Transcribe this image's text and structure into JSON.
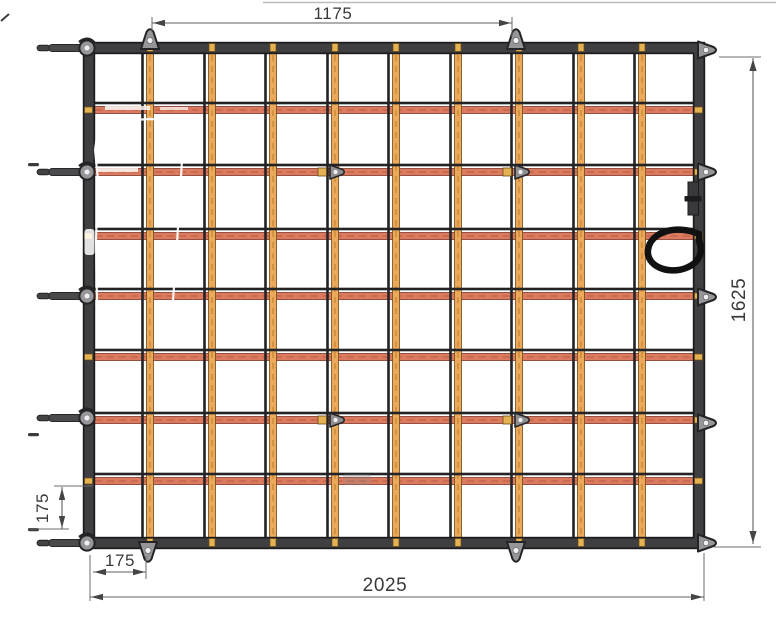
{
  "drawing": {
    "title": "cargo net technical drawing",
    "type": "flat cargo / load-securing net, plan view with dimensions"
  },
  "dimensions": {
    "top_width": {
      "label": "1175"
    },
    "right_height": {
      "label": "1625"
    },
    "bottom_width": {
      "label": "2025"
    },
    "edge_margin_vertical": {
      "label": "175"
    },
    "edge_margin_horizontal": {
      "label": "175"
    }
  },
  "net": {
    "frame": {
      "x": 89,
      "y": 48,
      "w": 610,
      "h": 495,
      "thickness": 9,
      "color": "#3f3f42",
      "outer_color": "#1b1b1d"
    },
    "columns": [
      150,
      212,
      273,
      335,
      396,
      458,
      519,
      581,
      642
    ],
    "rows": [
      110,
      172,
      236,
      296,
      357,
      420,
      481
    ],
    "strap_w": 7,
    "rope_w": 2.6,
    "vertical_strap_color": "#eca95b",
    "vertical_strap_edge": "#6b4c17",
    "vertical_strap_texture": "#b5791f",
    "horizontal_strap_color": "#db7a5e",
    "horizontal_strap_edge": "#803526",
    "horizontal_strap_texture": "#b35a43",
    "rope_color": "#232325",
    "wrap_color": "#e4b250",
    "wrap_edge": "#6b4c17"
  },
  "fittings": {
    "metal_color": "#96969a",
    "metal_edge": "#242426",
    "hole_color": "#f0f0f0",
    "left_hooks_y": [
      48,
      172,
      296,
      418,
      543
    ],
    "right_rings_y": [
      50,
      172,
      297,
      423,
      543
    ],
    "top_rings_x": [
      150,
      516
    ],
    "bottom_rings_x": [
      148,
      516
    ],
    "interior_rings": [
      [
        332,
        172
      ],
      [
        517,
        172
      ],
      [
        332,
        420
      ],
      [
        517,
        420
      ]
    ],
    "tick_dashes": [
      [
        28,
        163
      ],
      [
        28,
        433
      ],
      [
        28,
        528
      ]
    ],
    "handle": {
      "x": 648,
      "y": 224,
      "color": "#111111",
      "note": "black webbing carry loop on right edge"
    }
  }
}
